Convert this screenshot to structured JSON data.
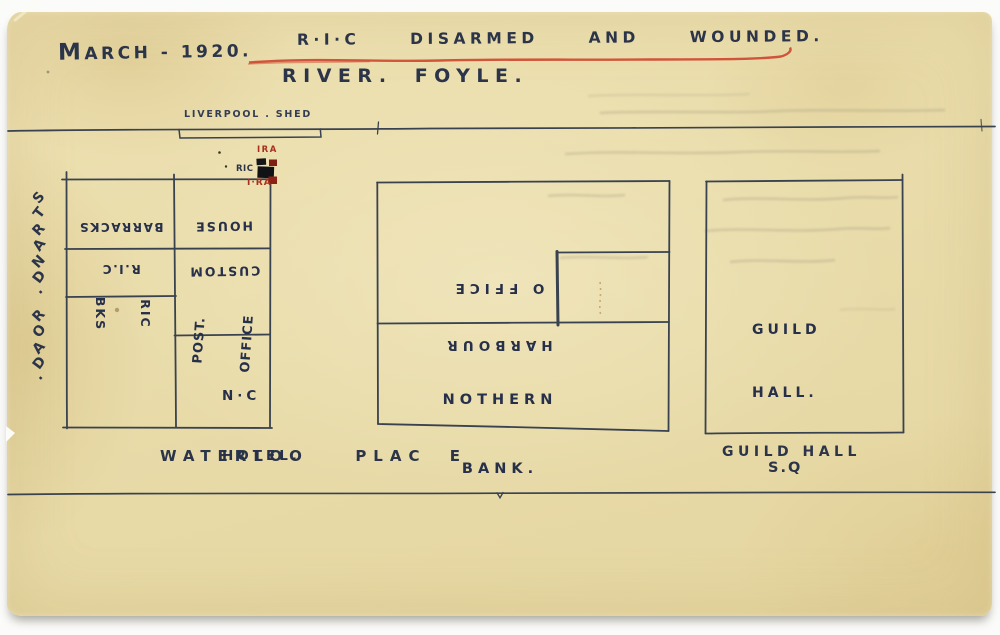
{
  "header": {
    "date": "MARCH - 1920.",
    "title": "R·I·C  DISARMED  AND  WOUNDED.",
    "subtitle": "RIVER. FOYLE."
  },
  "streets": {
    "liverpool_shed": "LIVERPOOL . SHED",
    "strand_road": "STRAND. ROAD.",
    "waterloo_place": "WATERLOO  PLAC E",
    "guild_hall_sq_line1": "GUILD HALL",
    "guild_hall_sq_line2": "S.Q"
  },
  "buildings": {
    "ric_barracks": {
      "line1": "R.I.C",
      "line2": "BARRACKS"
    },
    "custom_house": {
      "line1": "CUSTOM",
      "line2": "HOUSE"
    },
    "ric_bks": {
      "line1": "RIC",
      "line2": "BKS"
    },
    "post_office": {
      "line1": "POST.",
      "line2": "OFFICE"
    },
    "nc_hotel": {
      "line1": "N·C",
      "line2": "HOTEL."
    },
    "harbour_office": {
      "line1": "HARBOUR",
      "line2": "O FFICE"
    },
    "nothern_bank": {
      "line1": "NOTHERN",
      "line2": "BANK."
    },
    "guild_hall": {
      "line1": "GUILD",
      "line2": "HALL."
    }
  },
  "markers": {
    "ira_upper": "IRA",
    "ric": "RIC",
    "ira_lower": "I·RA"
  },
  "colors": {
    "paper": "#e9dcaa",
    "ink_text": "#2b3449",
    "ink_line": "#39424f",
    "underline_red": "#cd4930",
    "marker_red": "#8c2214",
    "marker_black": "#121418"
  }
}
